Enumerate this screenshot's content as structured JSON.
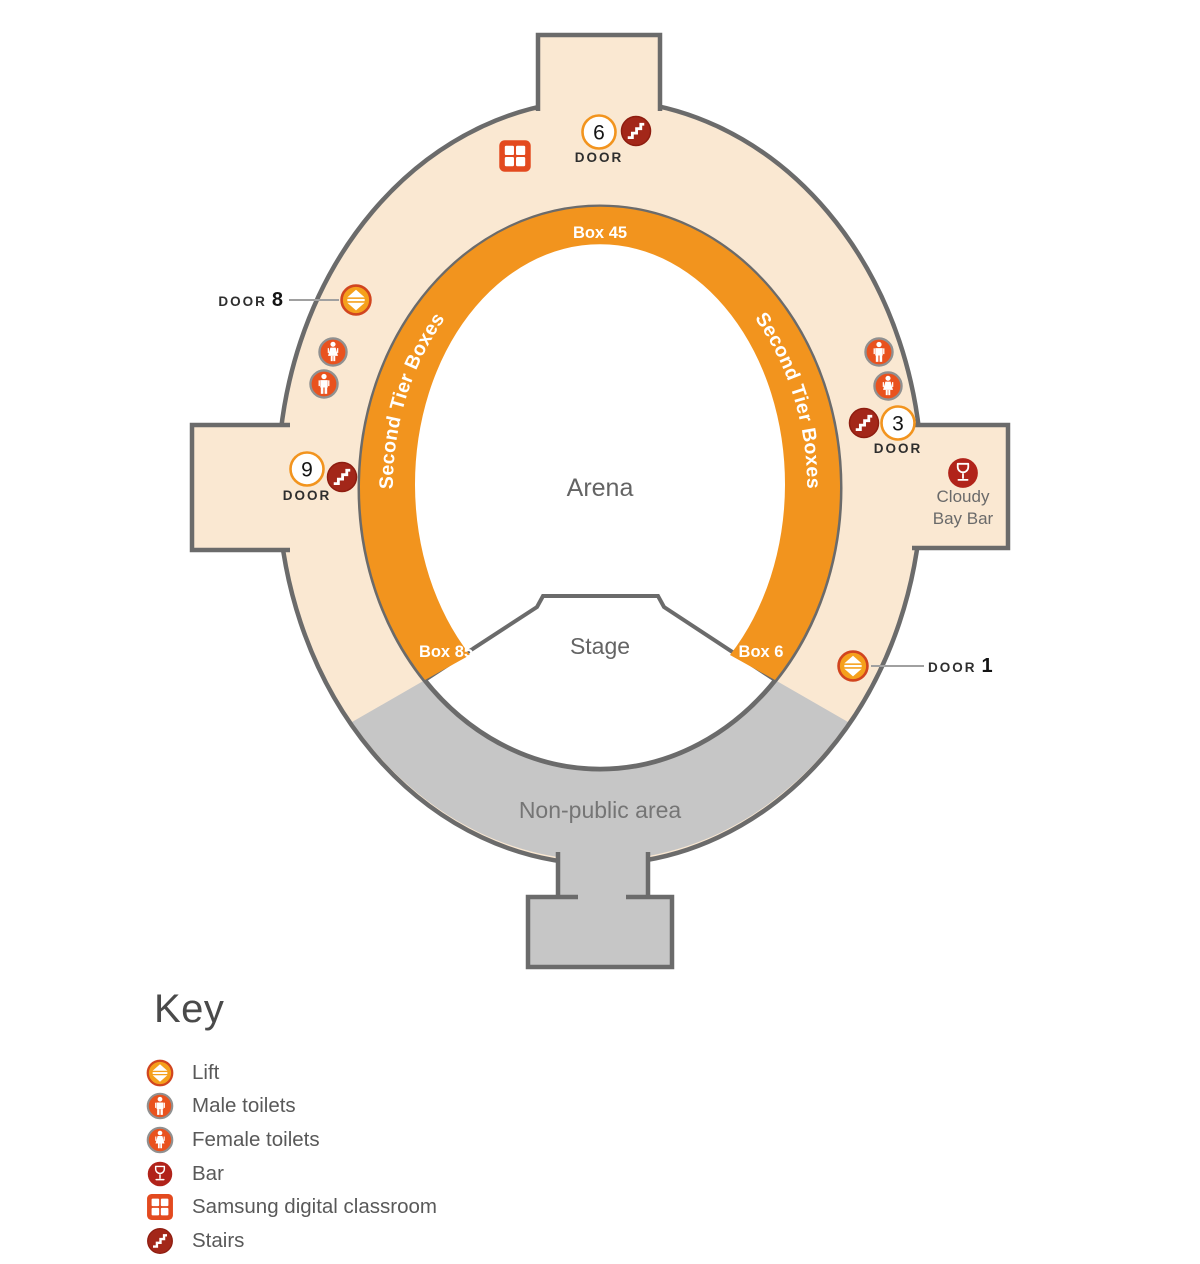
{
  "colors": {
    "concourse_peach": "#FAE8D2",
    "ring_orange": "#F2941E",
    "non_public_gray": "#C6C6C6",
    "outline_gray": "#6B6B6B",
    "lift_fill": "#F5A01C",
    "lift_border": "#D1451F",
    "toilet_fill": "#E9521E",
    "toilet_border": "#909090",
    "bar_fill": "#B1231A",
    "stairs_fill": "#A32719",
    "stairs_border": "#8E1D10",
    "classroom_fill": "#E34A1F",
    "label_gray": "#646464",
    "door_text": "#2E2E2E",
    "white": "#FFFFFF"
  },
  "map": {
    "arena_label": "Arena",
    "stage_label": "Stage",
    "non_public_label": "Non-public area",
    "tier_boxes_left": "Second Tier Boxes",
    "tier_boxes_right": "Second Tier Boxes",
    "box_top": "Box 45",
    "box_bottom_left": "Box 85",
    "box_bottom_right": "Box 6",
    "doors": {
      "door_6": {
        "number": "6",
        "word": "DOOR"
      },
      "door_9": {
        "number": "9",
        "word": "DOOR"
      },
      "door_3": {
        "number": "3",
        "word": "DOOR"
      },
      "door_8_callout": {
        "word": "DOOR",
        "number": "8"
      },
      "door_1_callout": {
        "word": "DOOR",
        "number": "1"
      }
    },
    "bar_callout": {
      "line1": "Cloudy",
      "line2": "Bay Bar"
    }
  },
  "key": {
    "title": "Key",
    "items": [
      {
        "icon": "lift-icon",
        "label": "Lift"
      },
      {
        "icon": "male-toilets-icon",
        "label": "Male toilets"
      },
      {
        "icon": "female-toilets-icon",
        "label": "Female toilets"
      },
      {
        "icon": "bar-icon",
        "label": "Bar"
      },
      {
        "icon": "samsung-digital-classroom-icon",
        "label": "Samsung digital classroom"
      },
      {
        "icon": "stairs-icon",
        "label": "Stairs"
      }
    ]
  }
}
